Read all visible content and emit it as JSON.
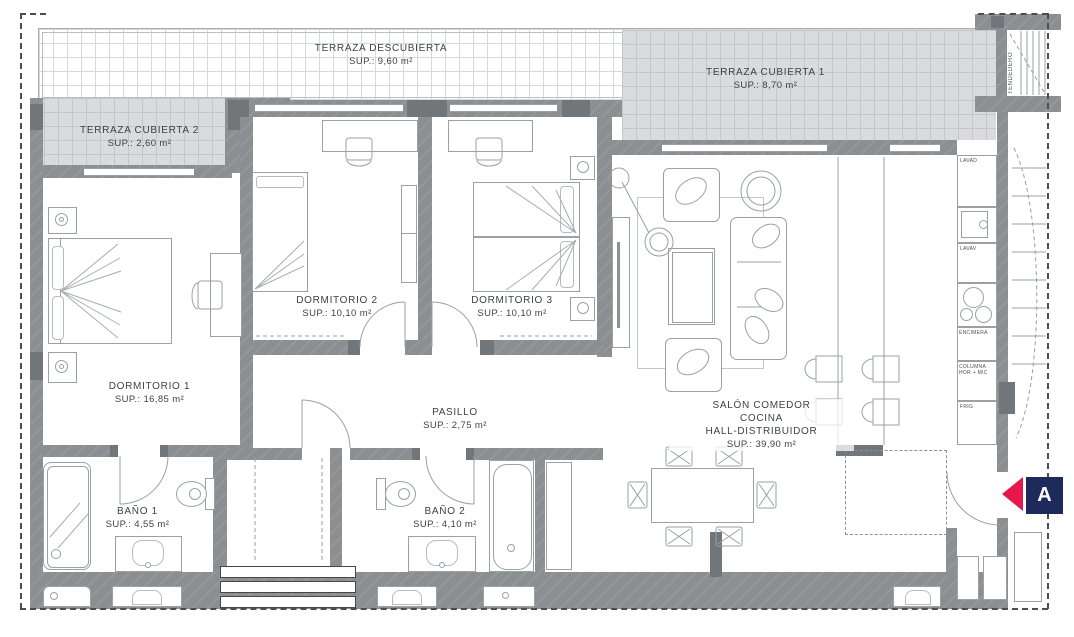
{
  "palette": {
    "wall": "#8b8f92",
    "wall_dark": "#70767a",
    "terrace_gray": "#d9dbdc",
    "line": "#9aa0a6",
    "text": "#3f4243",
    "boundary_dash": "#4d4d4d",
    "marker_red": "#e5184c",
    "marker_navy": "#1f2a5c"
  },
  "plan": {
    "terraza_descubierta": {
      "name": "TERRAZA DESCUBIERTA",
      "area": "SUP.: 9,60 m²"
    },
    "terraza_cubierta_1": {
      "name": "TERRAZA CUBIERTA 1",
      "area": "SUP.: 8,70 m²"
    },
    "terraza_cubierta_2": {
      "name": "TERRAZA CUBIERTA 2",
      "area": "SUP.: 2,60 m²"
    },
    "dormitorio_1": {
      "name": "DORMITORIO 1",
      "area": "SUP.: 16,85 m²"
    },
    "dormitorio_2": {
      "name": "DORMITORIO 2",
      "area": "SUP.: 10,10 m²"
    },
    "dormitorio_3": {
      "name": "DORMITORIO 3",
      "area": "SUP.: 10,10 m²"
    },
    "pasillo": {
      "name": "PASILLO",
      "area": "SUP.: 2,75 m²"
    },
    "bano_1": {
      "name": "BAÑO 1",
      "area": "SUP.: 4,55 m²"
    },
    "bano_2": {
      "name": "BAÑO 2",
      "area": "SUP.: 4,10 m²"
    },
    "salon": {
      "name_line1": "SALÓN COMEDOR",
      "name_line2": "COCINA",
      "name_line3": "HALL-DISTRIBUIDOR",
      "area": "SUP.: 39,90 m²"
    },
    "tendedero": {
      "name": "TENDEDERO"
    }
  },
  "kitchen": {
    "lavad": "LAVAD",
    "lavav": "LAVAV",
    "encimera": "ENCIMERA",
    "columna": {
      "line1": "COLUMNA",
      "line2": "HOR + MIC"
    },
    "frig": "FRIG"
  },
  "section_marker": {
    "label": "A"
  }
}
